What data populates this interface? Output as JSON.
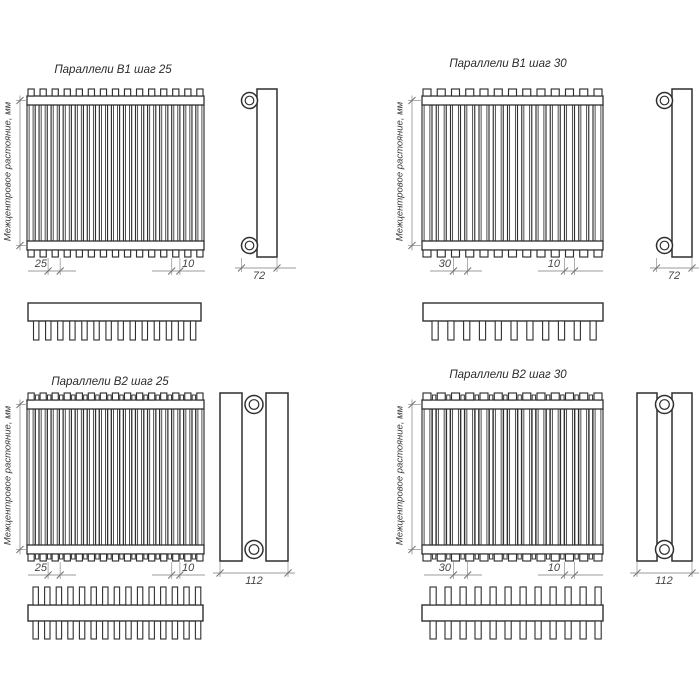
{
  "axis_label": "Межцентровое растояние, мм",
  "colors": {
    "background": "#ffffff",
    "line": "#2f2f2f",
    "dim_line": "#9b9b9b",
    "tick": "#757575",
    "text": "#454545"
  },
  "panels": [
    {
      "id": "b1-step-25",
      "title": "Параллели В1 шаг 25",
      "type": "B1",
      "front_tubes": 15,
      "top_teeth": 14,
      "dims": {
        "pitch": "25",
        "tube": "10",
        "depth": "72"
      }
    },
    {
      "id": "b1-step-30",
      "title": "Параллели В1 шаг 30",
      "type": "B1",
      "front_tubes": 13,
      "top_teeth": 11,
      "dims": {
        "pitch": "30",
        "tube": "10",
        "depth": "72"
      }
    },
    {
      "id": "b2-step-25",
      "title": "Параллели В2 шаг 25",
      "type": "B2",
      "front_tubes": 15,
      "top_teeth": 15,
      "dims": {
        "pitch": "25",
        "tube": "10",
        "depth": "112"
      }
    },
    {
      "id": "b2-step-30",
      "title": "Параллели В2 шаг 30",
      "type": "B2",
      "front_tubes": 13,
      "top_teeth": 12,
      "dims": {
        "pitch": "30",
        "tube": "10",
        "depth": "112"
      }
    }
  ]
}
